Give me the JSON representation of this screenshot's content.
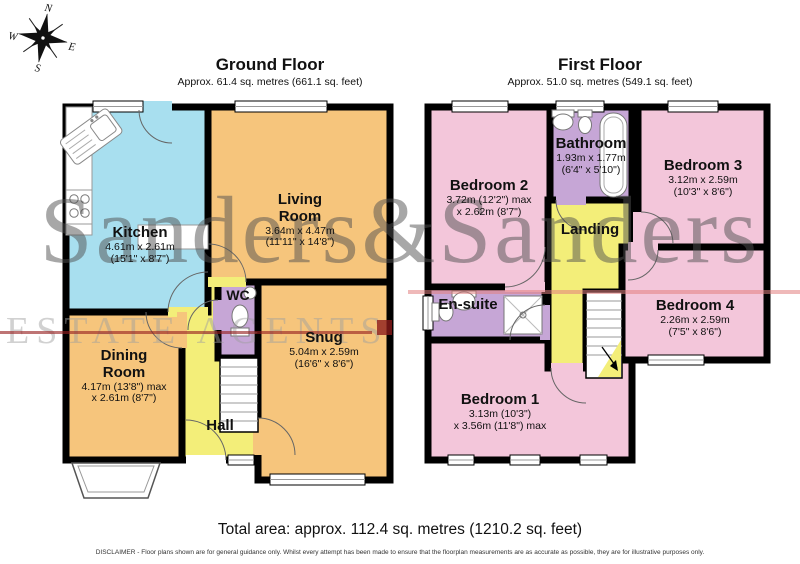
{
  "compass": {
    "n": "N",
    "e": "E",
    "s": "S",
    "w": "W"
  },
  "watermark": {
    "name_text": "Sanders&Sanders",
    "estate_text": "ESTATE AGENTS"
  },
  "ground": {
    "title": "Ground Floor",
    "subtitle": "Approx. 61.4 sq. metres (661.1 sq. feet)",
    "rooms": {
      "kitchen": {
        "name": "Kitchen",
        "d1": "4.61m x 2.61m",
        "d2": "(15'1\" x 8'7\")"
      },
      "living": {
        "n1": "Living",
        "n2": "Room",
        "d1": "3.64m x 4.47m",
        "d2": "(11'11\" x 14'8\")"
      },
      "dining": {
        "n1": "Dining",
        "n2": "Room",
        "d1": "4.17m (13'8\") max",
        "d2": "x 2.61m (8'7\")"
      },
      "wc": {
        "name": "WC"
      },
      "snug": {
        "name": "Snug",
        "d1": "5.04m x 2.59m",
        "d2": "(16'6\" x 8'6\")"
      },
      "hall": {
        "name": "Hall"
      }
    }
  },
  "first": {
    "title": "First Floor",
    "subtitle": "Approx. 51.0 sq. metres (549.1 sq. feet)",
    "rooms": {
      "bedroom2": {
        "name": "Bedroom 2",
        "d1": "3.72m (12'2\") max",
        "d2": "x 2.62m (8'7\")"
      },
      "bathroom": {
        "name": "Bathroom",
        "d1": "1.93m x 1.77m",
        "d2": "(6'4\" x 5'10\")"
      },
      "bedroom3": {
        "name": "Bedroom 3",
        "d1": "3.12m x 2.59m",
        "d2": "(10'3\" x 8'6\")"
      },
      "landing": {
        "name": "Landing"
      },
      "ensuite": {
        "name": "En-suite"
      },
      "bedroom4": {
        "name": "Bedroom 4",
        "d1": "2.26m x 2.59m",
        "d2": "(7'5\" x 8'6\")"
      },
      "bedroom1": {
        "name": "Bedroom 1",
        "d1": "3.13m (10'3\")",
        "d2": "x 3.56m (11'8\") max"
      }
    }
  },
  "footer": {
    "total": "Total area: approx. 112.4 sq. metres (1210.2 sq. feet)",
    "disclaimer": "DISCLAIMER - Floor plans shown are for general guidance only. Whilst every attempt has been made to ensure that the floorplan measurements are as accurate as possible, they are for illustrative purposes only."
  },
  "colors": {
    "kitchen": "#a8dfef",
    "reception": "#f6c57c",
    "hall_landing": "#f3ee79",
    "bath_wc": "#c6a6d6",
    "bedroom": "#f3c6da",
    "wall": "#000000",
    "watermark_red": "#8b1a1a"
  }
}
